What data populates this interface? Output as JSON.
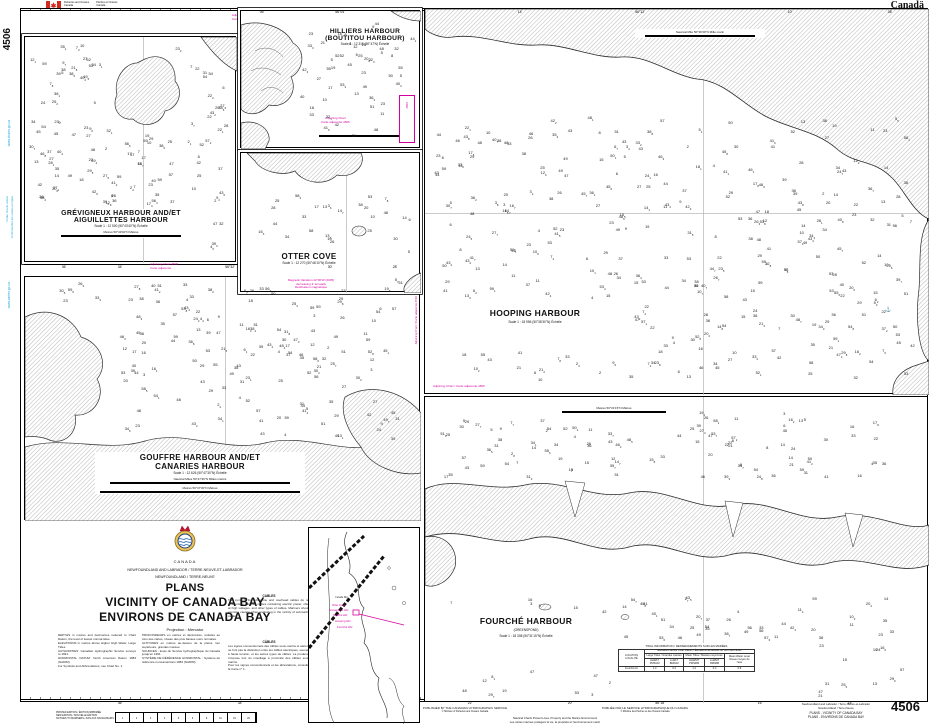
{
  "colors": {
    "magenta": "#d6009e",
    "cyan": "#1ea7d6"
  },
  "meta": {
    "wordmark": "Canadä",
    "number": "4506"
  },
  "gov": {
    "en1": "Fisheries and Oceans",
    "en2": "Canada",
    "fr1": "Pêches et Océans",
    "fr2": "Canada"
  },
  "edge": {
    "number": "4506",
    "web_en": "www.charts.gc.ca",
    "order_en": "Order charts online",
    "order_fr": "Commandez les cartes en ligne",
    "web_fr": "www.cartes.gc.ca"
  },
  "adjoin": {
    "l1": "Adjoining Chart",
    "l2": "Carte adjacente",
    "num": "4506",
    "inline": "Adjoining Chart / Carte adjacente 4506"
  },
  "panels": {
    "grevigneux": {
      "t1": "GRÉVIGNEUX HARBOUR AND/ET",
      "t2": "AIGUILLETTES HARBOUR",
      "scale": "Scale 1 : 12 500 (50°43'40\"N) Échelle",
      "bar": "Metres   50°43'40\"N   Mètres"
    },
    "hilliers": {
      "t1": "HILLIERS HARBOUR",
      "t2": "(BOUTITOU HARBOUR)",
      "scale": "Scale 1 : 12 315 (50°47'N) Échelle"
    },
    "otter": {
      "t": "OTTER COVE",
      "scale": "Scale 1 : 12 270 (50°46'10\"N) Échelle",
      "m1": "Magnetic Variation 22°30'W (2005)",
      "m2": "decreasing 3' annually",
      "m3": "Déclinaison magnétique"
    },
    "gouffre": {
      "t1": "GOUFFRE HARBOUR AND/ET",
      "t2": "CANARIES HARBOUR",
      "scale": "Scale 1 : 12 626 (50°47'30\"N) Échelle",
      "bar1": "Nautical Miles   50°47'30\"N   Milles marins",
      "bar2": "Metres   50°47'30\"N   Mètres"
    },
    "hooping": {
      "t": "HOOPING HARBOUR",
      "scale": "Scale 1 : 18 956 (50°36'30\"N) Échelle",
      "bar": "Nautical Mile   50°36'30\"N   Mille marin"
    },
    "fourche": {
      "t": "FOURCHÉ HARBOUR",
      "sub": "(GREENSPOND)",
      "scale": "Scale 1 : 18 308 (50°31'15\"N) Échelle",
      "bar": "Metres   50°31'15\"N   Mètres"
    }
  },
  "titleblock": {
    "country": "CANADA",
    "province": "NEWFOUNDLAND AND LABRADOR / TERRE-NEUVE-ET-LABRADOR",
    "region": "NEWFOUNDLAND / TERRE-NEUVE",
    "t1": "PLANS",
    "t2": "VICINITY OF CANADA BAY",
    "t3": "ENVIRONS DE CANADA BAY",
    "projection": "Projection : Mercator",
    "notes1": "DEPTHS in metres and decimetres reduced to Chart Datum, the level of lowest normal tides.\nELEVATIONS in metres above Higher High Water, Large Tides.\nAUTHORITIES: Canadian Hydrographic Service surveys to 1991.\nHORIZONTAL DATUM: North American Datum 1983 (NAD83).\nFor Symbols and Abbreviations, see Chart No. 1.",
    "notes2": "PROFONDEURS en mètres et décimètres, réduites au zéro des cartes, niveau des plus basses mers normales.\nALTITUDES en mètres au-dessus de la pleine mer supérieure, grandes marées.\nSOURCES : levés du Service hydrographique du Canada jusqu'en 1991.\nSYSTÈME DE RÉFÉRENCE HORIZONTAL : Système de référence nord-américain 1983 (NAD83).",
    "cables_h": "CABLES",
    "cables": "The symbols for submarine and overhead cables do not differentiate between cables containing electric power, often at high voltages, and other types of cables. Mariners should exercise caution when anchoring in the vicinity of submarine cables.",
    "cables_h_fr": "CÂBLES",
    "cables_fr": "Les signes conventionnels des câbles sous-marins et aériens ne font pas la distinction entre les câbles électriques, souvent à haute tension, et les autres types de câbles. La prudence s'impose lors du mouillage à proximité des câbles sous-marins.\nPour les signes conventionnels et les abréviations, consulter la Carte n° 1."
  },
  "tide": {
    "title": "TIDAL INFORMATION / RENSEIGNEMENTS SUR LES MARÉES",
    "loc": "LOCATION\nLOCALITÉ",
    "elev": "Elevations above Chart Datum / Élévations au-dessus du zéro des cartes",
    "g1": "Large Tides / Grandes marées",
    "g2": "Mean Tides / Marées moyennes",
    "g3": "Mean Water Level\nNiveau moyen de l'eau",
    "sub": [
      "HHWLT\nPMSGM",
      "LLWLT\nBMIGM",
      "HHWMT\nPMSMM",
      "LLWMT\nBMIMM"
    ],
    "row": "Fourché Hr",
    "vals": [
      "1.4",
      "0.2",
      "1.2",
      "0.4",
      "0.8"
    ]
  },
  "footer": {
    "pub_en": "PUBLISHED BY THE CANADIAN HYDROGRAPHIC SERVICE",
    "copy_en": "© Minister of Fisheries and Oceans Canada",
    "pub_fr": "PUBLIÉE PAR LE SERVICE HYDROGRAPHIQUE DU CANADA",
    "copy_fr": "© Ministre des Pêches et des Océans Canada",
    "slogan_en": "Nautical Charts Protect Lives, Property and the Marine Environment",
    "slogan_fr": "Les cartes marines protègent la vie, la propriété et l'environnement marin",
    "printed": "PRINTED EDITION / ÉDITION IMPRIMÉE\nNEW EDITION / NOUVELLE ÉDITION\nNOTICES TO MARINERS / AVIS AUX NAVIGATEURS",
    "corner1": "Newfoundland and Labrador / Terre-Neuve-et-Labrador",
    "corner2": "Newfoundland / Terre-Neuve",
    "corner3": "PLANS - VICINITY OF CANADA BAY",
    "corner4": "PLANS - ENVIRONS DE CANADA BAY",
    "number": "4506"
  },
  "index": {
    "water": "Canada Bay",
    "labels": [
      {
        "t": "Otter Cove",
        "x": 332,
        "y": 604
      },
      {
        "t": "Grévigneux Hbr",
        "x": 329,
        "y": 609
      },
      {
        "t": "Gouffre Hbr",
        "x": 333,
        "y": 614
      },
      {
        "t": "Hooping Hbr",
        "x": 335,
        "y": 620
      },
      {
        "t": "Fourché Hbr",
        "x": 337,
        "y": 626
      }
    ]
  },
  "ticks": {
    "top": [
      {
        "x": 262,
        "t": "05'"
      },
      {
        "x": 340,
        "t": "56°04'"
      },
      {
        "x": 520,
        "t": "14'"
      },
      {
        "x": 640,
        "t": "56°12'"
      },
      {
        "x": 790,
        "t": "10'"
      },
      {
        "x": 890,
        "t": "08'"
      }
    ],
    "mid": [
      {
        "x": 64,
        "t": "36'"
      },
      {
        "x": 120,
        "t": "34'"
      },
      {
        "x": 230,
        "t": "56°32'"
      },
      {
        "x": 330,
        "t": "30'"
      },
      {
        "x": 395,
        "t": "28'"
      }
    ],
    "bottom": [
      {
        "x": 120,
        "t": "36'"
      },
      {
        "x": 240,
        "t": "34'"
      },
      {
        "x": 470,
        "t": "22'"
      },
      {
        "x": 570,
        "t": "20'"
      },
      {
        "x": 660,
        "t": "56°18'"
      },
      {
        "x": 760,
        "t": "16'"
      },
      {
        "x": 850,
        "t": "14'"
      }
    ]
  },
  "depthcells": [
    "1",
    "2",
    "3",
    "4",
    "5",
    "6",
    "8",
    "10",
    "15",
    "20"
  ],
  "roses": [
    {
      "cx": 75,
      "cy": 151,
      "r": 40,
      "star": false,
      "needle": 68
    },
    {
      "cx": 298,
      "cy": 371,
      "r": 50,
      "star": false,
      "needle": 70
    },
    {
      "cx": 655,
      "cy": 288,
      "r": 60,
      "star": true,
      "needle": 66
    },
    {
      "cx": 831,
      "cy": 447,
      "r": 50,
      "star": true,
      "needle": 72
    }
  ],
  "soundings": {
    "seed": 11,
    "panels": [
      {
        "x": 32,
        "y": 46,
        "w": 196,
        "h": 206,
        "n": 165,
        "ex": [
          [
            112,
            52,
            78,
            82
          ],
          [
            26,
            206,
            180,
            50
          ]
        ]
      },
      {
        "x": 302,
        "y": 24,
        "w": 112,
        "h": 112,
        "n": 52,
        "ex": [
          [
            390,
            88,
            34,
            56
          ]
        ]
      },
      {
        "x": 250,
        "y": 196,
        "w": 164,
        "h": 88,
        "n": 46,
        "ex": [
          [
            252,
            250,
            140,
            40
          ]
        ]
      },
      {
        "x": 48,
        "y": 284,
        "w": 350,
        "h": 156,
        "n": 185,
        "ex": [
          [
            24,
            304,
            90,
            145
          ]
        ]
      },
      {
        "x": 436,
        "y": 118,
        "w": 478,
        "h": 262,
        "n": 340,
        "ex": [
          [
            438,
            298,
            190,
            50
          ]
        ]
      },
      {
        "x": 436,
        "y": 408,
        "w": 460,
        "h": 70,
        "n": 100,
        "ex": [
          [
            545,
            404,
            130,
            20
          ]
        ]
      },
      {
        "x": 448,
        "y": 598,
        "w": 456,
        "h": 98,
        "n": 125,
        "ex": [
          [
            436,
            612,
            176,
            60
          ],
          [
            612,
            640,
            196,
            58
          ]
        ]
      }
    ]
  }
}
